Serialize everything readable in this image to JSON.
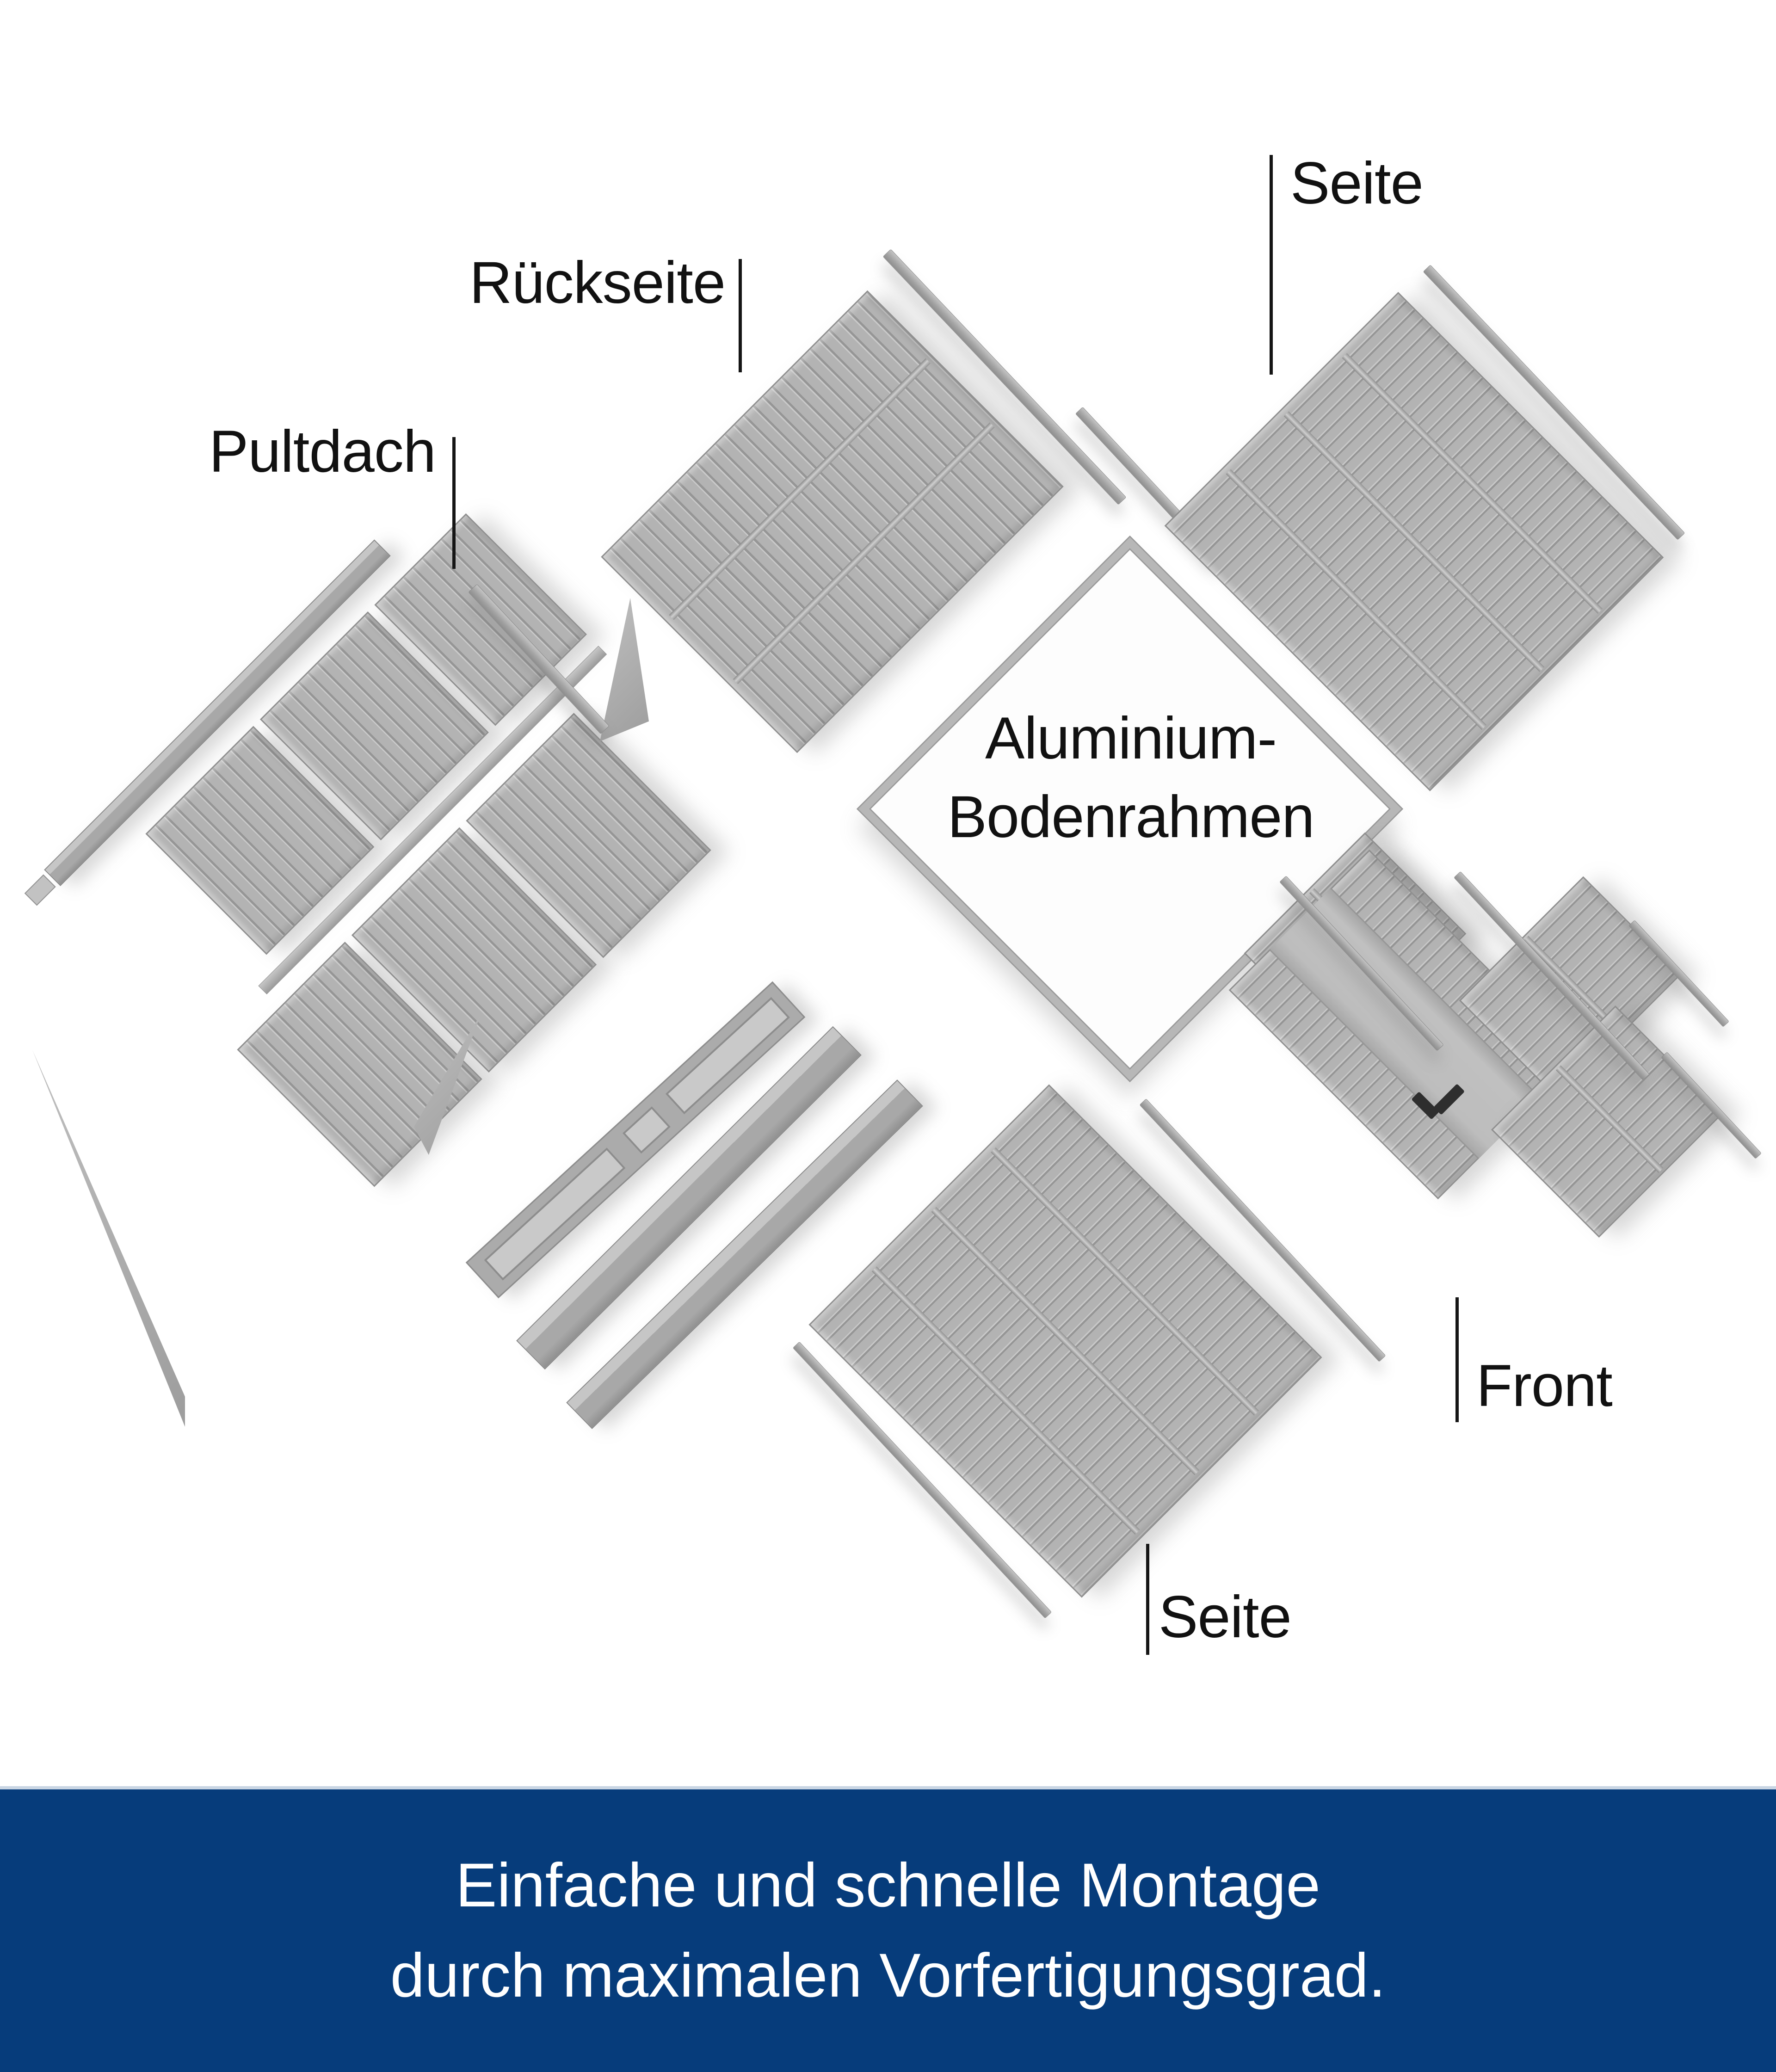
{
  "labels": {
    "roof": "Pultdach",
    "back": "Rückseite",
    "side_top": "Seite",
    "floor_line1": "Aluminium-",
    "floor_line2": "Bodenrahmen",
    "front": "Front",
    "side_bottom": "Seite"
  },
  "banner": {
    "line1": "Einfache und schnelle Montage",
    "line2": "durch maximalen Vorfertigungsgrad.",
    "background": "#063c7b",
    "top_stripe": "#c9d5e3",
    "text_color": "#ffffff"
  },
  "materials": {
    "panel_gray": "#b2b2b2",
    "rib_dark": "#979797",
    "rib_light": "#c9c9c9",
    "edge_gray": "#8f8f8f",
    "rail_gray": "#a9a9a9",
    "door_handle": "#2e2e2e",
    "label_color": "#111111"
  }
}
